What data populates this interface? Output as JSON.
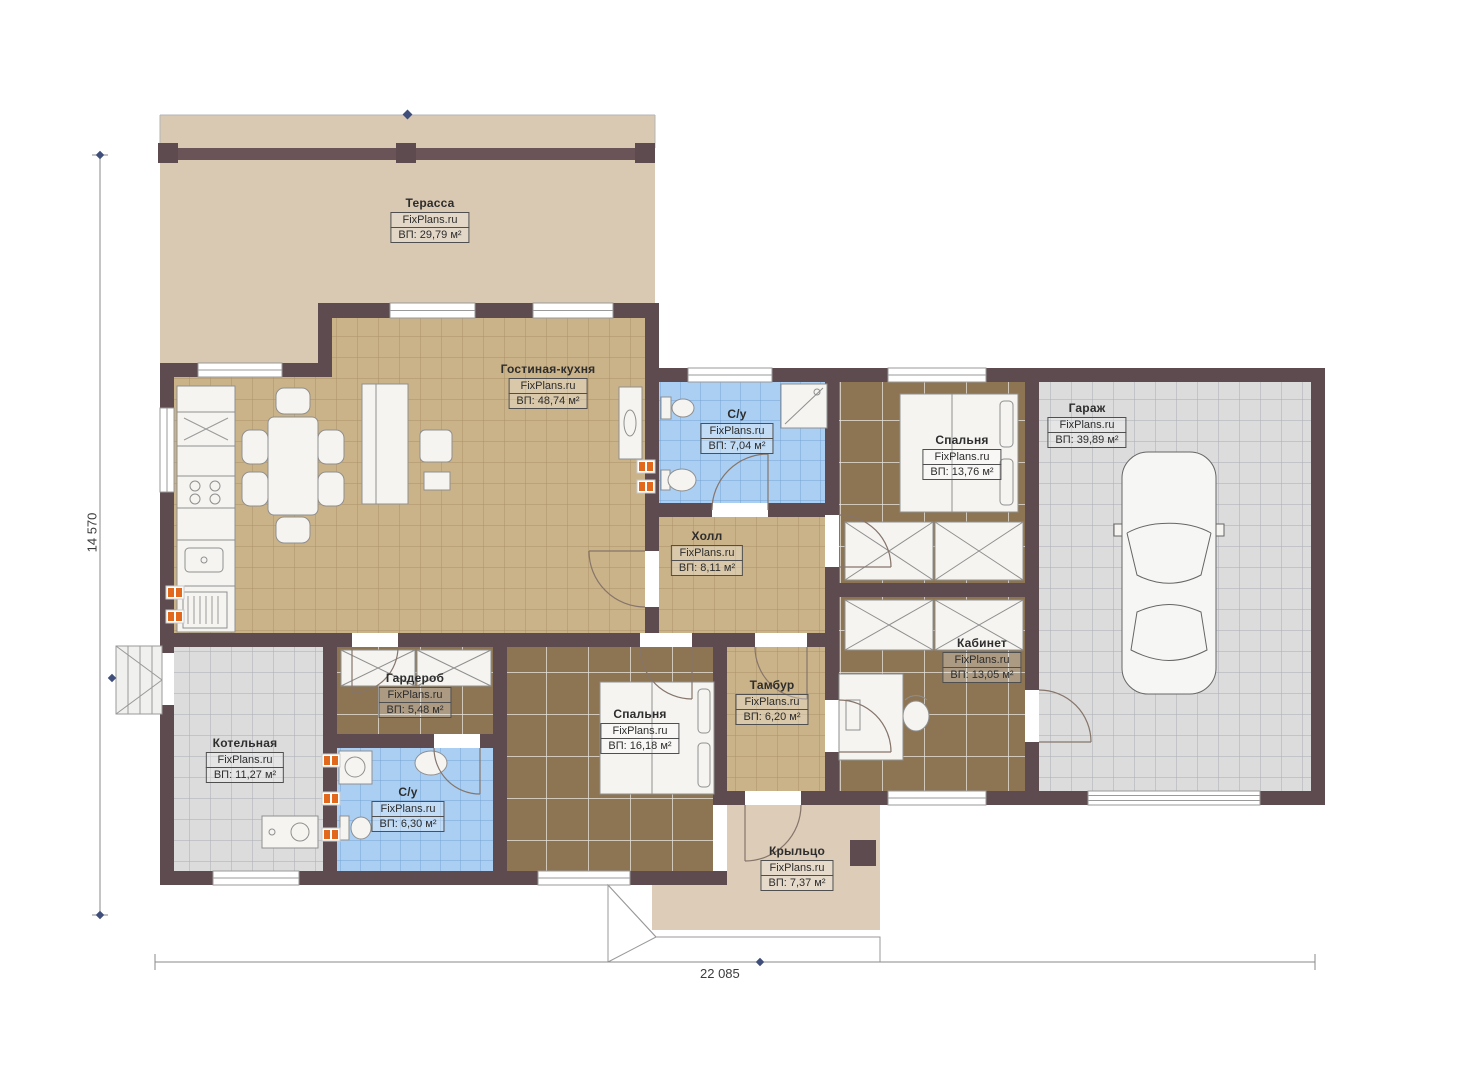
{
  "plan": {
    "brand": "FixPlans.ru",
    "rooms": [
      {
        "key": "terrace",
        "name": "Терасса",
        "area": "ВП: 29,79 м²"
      },
      {
        "key": "living-kitchen",
        "name": "Гостиная-кухня",
        "area": "ВП: 48,74 м²"
      },
      {
        "key": "bathroom-top",
        "name": "С/у",
        "area": "ВП: 7,04 м²"
      },
      {
        "key": "bedroom-top",
        "name": "Спальня",
        "area": "ВП: 13,76 м²"
      },
      {
        "key": "garage",
        "name": "Гараж",
        "area": "ВП: 39,89 м²"
      },
      {
        "key": "hall",
        "name": "Холл",
        "area": "ВП: 8,11 м²"
      },
      {
        "key": "wardrobe",
        "name": "Гардероб",
        "area": "ВП: 5,48 м²"
      },
      {
        "key": "boiler-room",
        "name": "Котельная",
        "area": "ВП: 11,27 м²"
      },
      {
        "key": "bathroom-bottom",
        "name": "С/у",
        "area": "ВП: 6,30 м²"
      },
      {
        "key": "bedroom-bottom",
        "name": "Спальня",
        "area": "ВП: 16,18 м²"
      },
      {
        "key": "tambour",
        "name": "Тамбур",
        "area": "ВП: 6,20 м²"
      },
      {
        "key": "office",
        "name": "Кабинет",
        "area": "ВП: 13,05 м²"
      },
      {
        "key": "porch",
        "name": "Крыльцо",
        "area": "ВП: 7,37 м²"
      }
    ],
    "dimensions": {
      "total_width": "22 085",
      "total_height": "14 570"
    },
    "colors": {
      "wall": "#5e4b4f",
      "floor_tile": "#cbb389",
      "carpet": "#8d7452",
      "bath_tile": "#abcff2",
      "garage_tile": "#dcdcdc",
      "outdoor": "#d9c8b2",
      "radiator": "#e2691c"
    }
  }
}
